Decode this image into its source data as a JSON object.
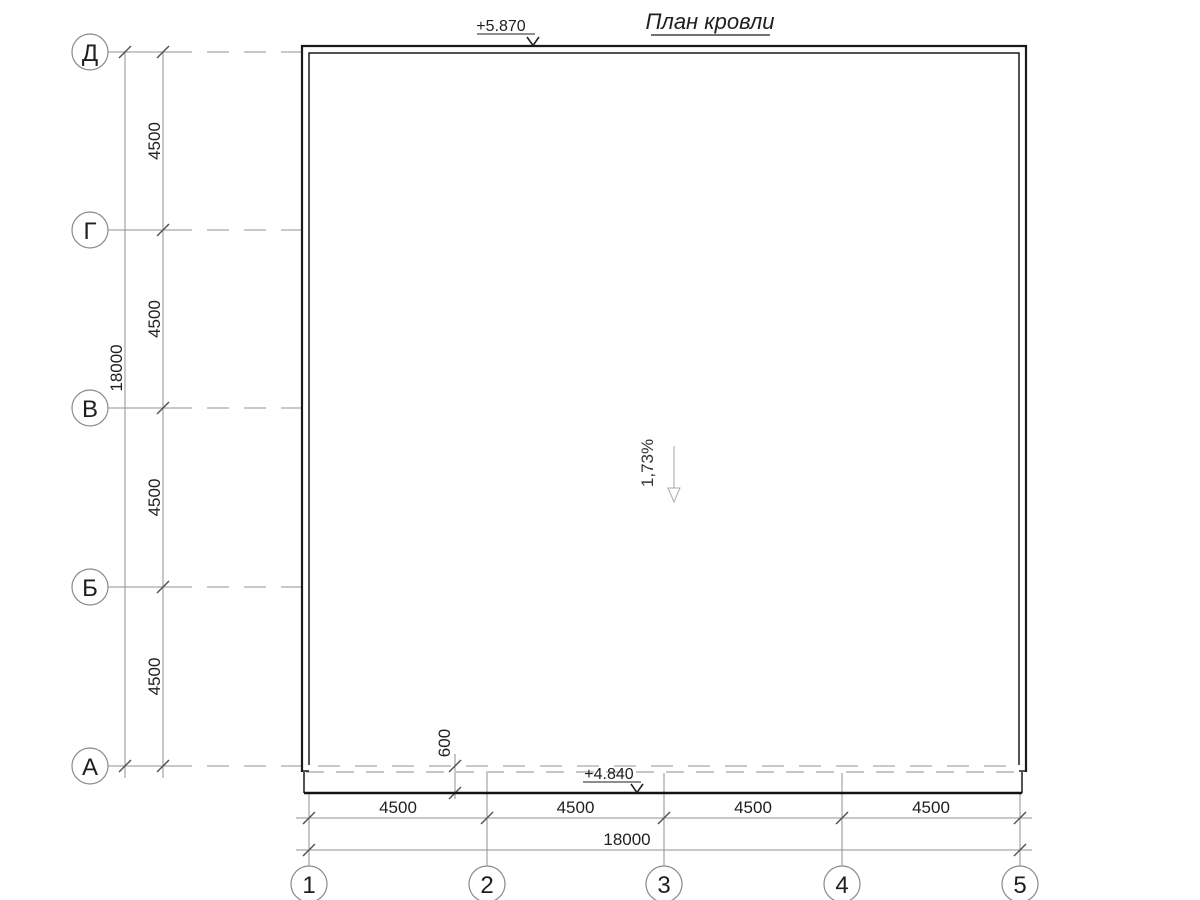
{
  "title": "План кровли",
  "axes": {
    "rows": [
      "Д",
      "Г",
      "В",
      "Б",
      "А"
    ],
    "cols": [
      "1",
      "2",
      "3",
      "4",
      "5"
    ]
  },
  "dimensions": {
    "left_segments": [
      "4500",
      "4500",
      "4500",
      "4500"
    ],
    "left_total": "18000",
    "bottom_segments": [
      "4500",
      "4500",
      "4500",
      "4500"
    ],
    "bottom_total": "18000",
    "eaves_overhang": "600"
  },
  "elevations": {
    "top": "+5.870",
    "bottom": "+4.840"
  },
  "slope": "1,73%",
  "colors": {
    "drawing_line": "#1a1a1a",
    "grid_line": "#919191",
    "tick": "#555555",
    "text": "#1f1f1f"
  }
}
